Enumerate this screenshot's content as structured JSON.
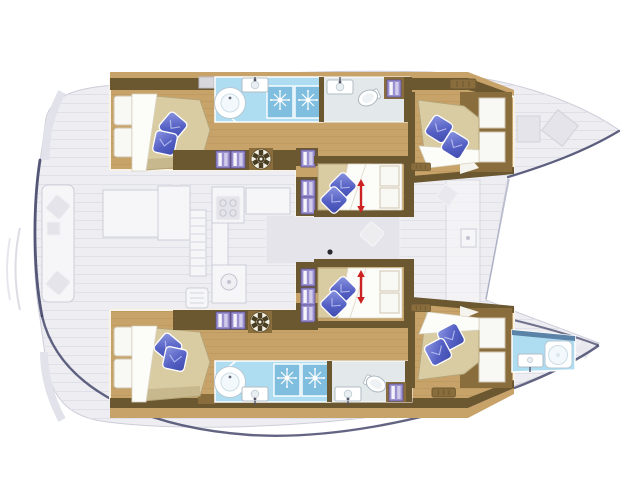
{
  "diagram": {
    "kind": "catamaran-yacht-floor-plan",
    "orientation": {
      "bow": "right",
      "stern": "left",
      "port_hull": "top",
      "starboard_hull": "bottom"
    },
    "hull_count": 2
  },
  "cabins": [
    {
      "id": "port-aft-cabin",
      "bed": "double",
      "pillow_count": 2
    },
    {
      "id": "port-mid-cabin",
      "bed": "double",
      "pillow_count": 2,
      "convertible_arrow": true
    },
    {
      "id": "port-forward-cabin",
      "bed": "double",
      "pillow_count": 2
    },
    {
      "id": "starboard-aft-cabin",
      "bed": "double",
      "pillow_count": 2
    },
    {
      "id": "starboard-mid-cabin",
      "bed": "double",
      "pillow_count": 2,
      "convertible_arrow": true
    },
    {
      "id": "starboard-forward-cabin",
      "bed": "double",
      "pillow_count": 2
    }
  ],
  "bathrooms": [
    {
      "id": "port-shower-room",
      "features": [
        "round-shower",
        "sink",
        "jet-panel",
        "jet-panel"
      ]
    },
    {
      "id": "port-wc",
      "features": [
        "toilet",
        "sink",
        "towel-shelf"
      ]
    },
    {
      "id": "starboard-shower-room",
      "features": [
        "round-shower",
        "sink",
        "jet-panel",
        "jet-panel"
      ]
    },
    {
      "id": "starboard-wc",
      "features": [
        "toilet",
        "sink",
        "towel-shelf"
      ]
    },
    {
      "id": "starboard-bow-bathroom",
      "features": [
        "shower",
        "sink"
      ]
    }
  ],
  "icons": {
    "pillow": "blue diamond cushion",
    "towel": "folded purple towels",
    "wheel": "round vent wheel",
    "jet": "shower jet starburst",
    "arrow": "red double-headed arrow",
    "vent": "air vent grille"
  },
  "colors": {
    "background": "#ffffff",
    "deck_fill": "#ededf2",
    "deck_line": "#cdcdd9",
    "deck_white": "#f6f6f9",
    "outline_navy": "#3b3d63",
    "hull_wood": "#c8a369",
    "wood_grain": "#9c7a42",
    "furniture_dark": "#6b5730",
    "furniture_mid": "#8a6d3c",
    "cream_outline": "#f7f3e6",
    "mattress": "#d9cca3",
    "mattress_shade": "#b6a478",
    "duvet": "#fcfcf9",
    "pillow_dark": "#3f4aad",
    "pillow_light": "#8d97e2",
    "bath_floor": "#aeddf2",
    "bath_panel": "#7fbede",
    "bath_dark": "#5b83a8",
    "fixture_stroke": "#a9b8c2",
    "towel": "#9a8fd0",
    "towel_stroke": "#5a4f92",
    "arrow_red": "#cc2222",
    "wheel_dark": "#493e22"
  }
}
